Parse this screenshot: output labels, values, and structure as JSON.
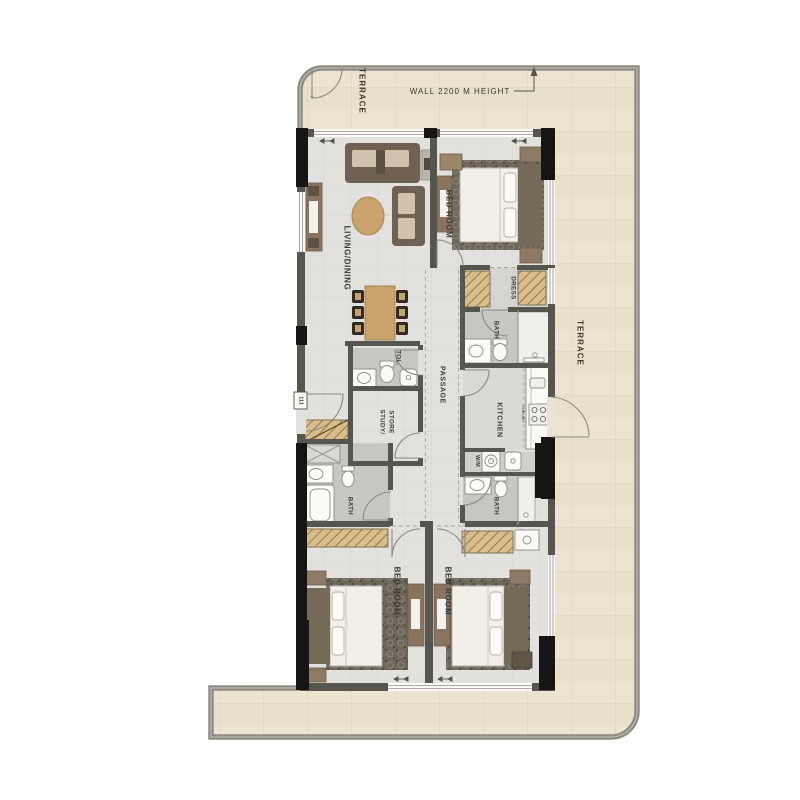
{
  "plan_title": "apartment-unit-floor-plan",
  "rooms": {
    "terrace_top": "TERRACE",
    "terrace_right": "TERRACE",
    "living_dining": "LIVING/DINING",
    "bedroom_top": "BED ROOM",
    "dress": "DRESS",
    "bath_top": "BATH",
    "toilet": "TOL.",
    "passage": "PASSAGE",
    "study_line1": "STUDY/",
    "study_line2": "STORE",
    "kitchen": "KITCHEN",
    "bath_left": "BATH",
    "bath_right": "BATH",
    "bedroom_left": "BED ROOM",
    "bedroom_right": "BED ROOM"
  },
  "annotations": {
    "wall_note": "WALL 2200 M HEIGHT",
    "unit_number": "111",
    "hob_unit": "HOB UNIT",
    "washing_machine": "W/M"
  },
  "colors": {
    "terrace_floor": "#ebe3cf",
    "terrace_wall": "#8e8c86",
    "apartment_floor": "#e2e1de",
    "wet_floor": "#c7c6c3",
    "wall": "#57554f",
    "column": "#171513",
    "wood": "#c9a36b",
    "sofa": "#6f6154",
    "wardrobe_hatch": "#d8bd8d",
    "label_text": "#3b3a36"
  }
}
